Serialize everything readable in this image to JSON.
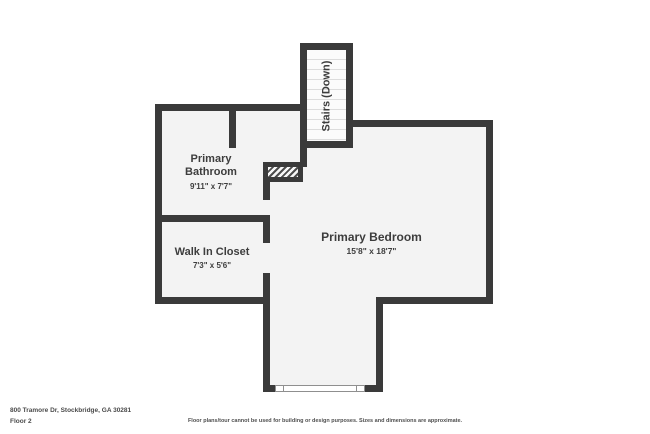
{
  "rooms": {
    "bathroom": {
      "name": "Primary Bathroom",
      "dims": "9'11\" x 7'7\""
    },
    "closet": {
      "name": "Walk In Closet",
      "dims": "7'3\" x 5'6\""
    },
    "bedroom": {
      "name": "Primary Bedroom",
      "dims": "15'8\" x 18'7\""
    },
    "stairs": {
      "name": "Stairs (Down)"
    }
  },
  "footer": {
    "address": "800 Tramore Dr, Stockbridge, GA 30281",
    "floor_label": "Floor 2",
    "disclaimer": "Floor plans/tour cannot be used for building or design purposes. Sizes and dimensions are approximate."
  },
  "colors": {
    "wall": "#3a3a3a",
    "room_fill": "#f3f3f3",
    "stairs_fill": "#fbfbfb",
    "tread": "#dcdcdc",
    "text": "#3d3d3d"
  }
}
